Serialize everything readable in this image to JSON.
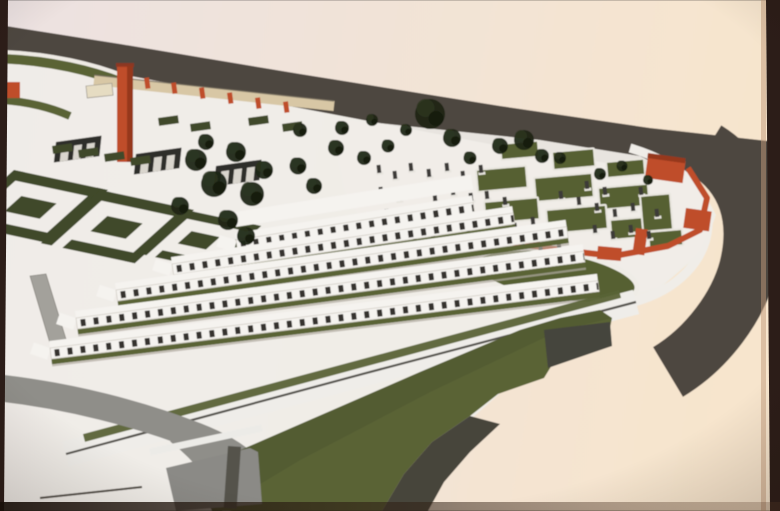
{
  "image": {
    "kind": "photograph-of-architectural-rendering",
    "subject": "aerial 3D site plan of a memorial cemetery complex printed on paper"
  },
  "palette": {
    "paper_left": "#ece2e2",
    "paper_mid": "#f1e3d8",
    "paper_right": "#f7e5cd",
    "border_dark": "#2c1d18",
    "road_dark": "#4e4741",
    "road_light": "#8f8e89",
    "ground_white": "#efede9",
    "terrace_white": "#f5f3ef",
    "niche_dark": "#35332f",
    "green_dark": "#3f4829",
    "green_mid": "#5a6336",
    "green_plot": "#566032",
    "tree_dark": "#1f2617",
    "red_wall": "#bf4e2b",
    "red_dark": "#96371f",
    "beige_wall": "#d8c7a5",
    "gray_block": "#8b8a86",
    "gray_dark": "#55534e"
  },
  "scene": {
    "elements": [
      {
        "name": "perimeter-road",
        "desc": "dark asphalt road wrapping the site from top-left around the right side"
      },
      {
        "name": "entrance-plaza",
        "desc": "paved plaza with decorative paving squares, red pylon monument, red posts, gate arches"
      },
      {
        "name": "memorial-garden",
        "desc": "formal parterre hedges in geometric spiral patterns"
      },
      {
        "name": "cemetery",
        "desc": "grave field with green burial plots, stone monuments, orange-red boundary wall and gate towers"
      },
      {
        "name": "columbarium-terraces",
        "desc": "five stepped white terrace walls with rows of dark niches"
      },
      {
        "name": "grass-slope",
        "desc": "large green embankment with grey retaining walls and ramps"
      },
      {
        "name": "trees",
        "desc": "dark evergreen trees"
      }
    ],
    "trees": [
      [
        196,
        160,
        1.1
      ],
      [
        214,
        184,
        1.3
      ],
      [
        236,
        152,
        1.0
      ],
      [
        252,
        194,
        1.2
      ],
      [
        228,
        220,
        1.0
      ],
      [
        264,
        170,
        0.9
      ],
      [
        206,
        142,
        0.8
      ],
      [
        246,
        236,
        0.9
      ],
      [
        180,
        206,
        0.9
      ],
      [
        298,
        166,
        0.85
      ],
      [
        314,
        186,
        0.8
      ],
      [
        336,
        148,
        0.8
      ],
      [
        364,
        158,
        0.7
      ],
      [
        300,
        130,
        0.7
      ],
      [
        342,
        128,
        0.7
      ],
      [
        388,
        146,
        0.65
      ],
      [
        430,
        114,
        1.5
      ],
      [
        452,
        138,
        0.9
      ],
      [
        470,
        158,
        0.65
      ],
      [
        500,
        146,
        0.8
      ],
      [
        524,
        140,
        1.0
      ],
      [
        542,
        156,
        0.7
      ],
      [
        560,
        158,
        0.6
      ],
      [
        600,
        174,
        0.6
      ],
      [
        622,
        166,
        0.55
      ],
      [
        648,
        180,
        0.5
      ],
      [
        372,
        120,
        0.6
      ],
      [
        406,
        130,
        0.6
      ]
    ],
    "monuments": [
      [
        378,
        170
      ],
      [
        394,
        176
      ],
      [
        410,
        168
      ],
      [
        428,
        174
      ],
      [
        446,
        168
      ],
      [
        462,
        176
      ],
      [
        480,
        170
      ],
      [
        380,
        192
      ],
      [
        398,
        198
      ],
      [
        416,
        192
      ],
      [
        434,
        198
      ],
      [
        452,
        192
      ],
      [
        470,
        198
      ],
      [
        386,
        214
      ],
      [
        404,
        220
      ],
      [
        422,
        214
      ],
      [
        440,
        220
      ],
      [
        458,
        214
      ],
      [
        396,
        236
      ],
      [
        414,
        242
      ],
      [
        432,
        236
      ],
      [
        450,
        242
      ],
      [
        468,
        236
      ],
      [
        486,
        196
      ],
      [
        504,
        202
      ],
      [
        496,
        222
      ],
      [
        514,
        228
      ],
      [
        532,
        222
      ],
      [
        550,
        228
      ],
      [
        522,
        246
      ],
      [
        540,
        252
      ],
      [
        558,
        246
      ],
      [
        576,
        252
      ],
      [
        560,
        196
      ],
      [
        578,
        202
      ],
      [
        596,
        208
      ],
      [
        614,
        214
      ],
      [
        632,
        208
      ],
      [
        594,
        230
      ],
      [
        612,
        236
      ],
      [
        630,
        230
      ],
      [
        648,
        236
      ],
      [
        586,
        186
      ],
      [
        604,
        192
      ],
      [
        640,
        192
      ],
      [
        656,
        214
      ]
    ],
    "paving_squares": [
      [
        46,
        114
      ],
      [
        102,
        122
      ],
      [
        160,
        130
      ],
      [
        218,
        138
      ],
      [
        0,
        144
      ]
    ],
    "red_posts": [
      [
        144,
        78
      ],
      [
        171,
        83
      ],
      [
        199,
        88
      ],
      [
        227,
        93
      ],
      [
        255,
        98
      ],
      [
        283,
        102
      ]
    ],
    "burial_plots": [
      [
        476,
        170,
        50,
        22
      ],
      [
        534,
        178,
        58,
        24
      ],
      [
        598,
        188,
        50,
        22
      ],
      [
        484,
        202,
        54,
        22
      ],
      [
        546,
        210,
        60,
        24
      ],
      [
        610,
        220,
        46,
        20
      ],
      [
        500,
        144,
        38,
        16
      ],
      [
        552,
        152,
        42,
        18
      ],
      [
        606,
        162,
        38,
        16
      ],
      [
        648,
        232,
        34,
        16
      ],
      [
        640,
        196,
        30,
        36
      ]
    ],
    "hedges": [
      [
        52,
        146
      ],
      [
        78,
        150
      ],
      [
        104,
        154
      ],
      [
        130,
        158
      ],
      [
        158,
        118
      ],
      [
        190,
        124
      ],
      [
        248,
        118
      ],
      [
        282,
        124
      ]
    ],
    "terrace_rows": [
      {
        "x": 236,
        "y": 240,
        "a": -9,
        "len": 240
      },
      {
        "x": 172,
        "y": 264,
        "a": -8.5,
        "len": 345
      },
      {
        "x": 116,
        "y": 290,
        "a": -8,
        "len": 455
      },
      {
        "x": 76,
        "y": 318,
        "a": -7.5,
        "len": 512
      },
      {
        "x": 50,
        "y": 348,
        "a": -7,
        "len": 552
      }
    ]
  }
}
